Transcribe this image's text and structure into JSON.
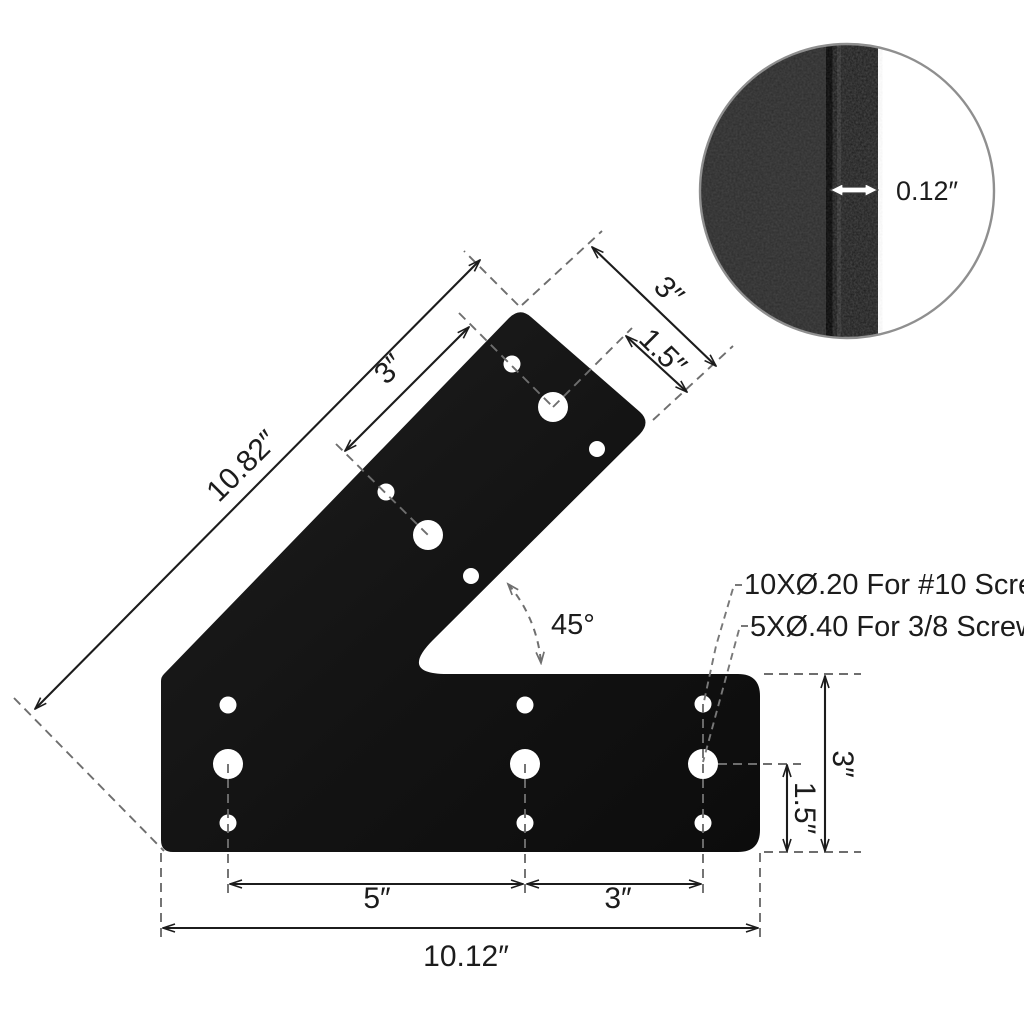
{
  "dimensions": {
    "diagonal_length": "10.82″",
    "diagonal_hole_spacing": "3″",
    "arm_end_width": "3″",
    "arm_end_hole_inset": "1.5″",
    "angle": "45°",
    "right_height": "3″",
    "right_hole_inset": "1.5″",
    "bottom_left_span": "5″",
    "bottom_right_span": "3″",
    "bottom_total": "10.12″"
  },
  "callouts": {
    "small_holes": "10XØ.20 For #10 Screws",
    "large_holes": "5XØ.40 For 3/8 Screws"
  },
  "detail_circle": {
    "thickness": "0.12″"
  },
  "colors": {
    "plate": "#131313",
    "dimension_line": "#1c1c1c",
    "extension_line": "#6e6e6e",
    "detail_face": "#2b2b2b",
    "detail_edge_strip": "#1b1b1b",
    "background": "#ffffff"
  }
}
